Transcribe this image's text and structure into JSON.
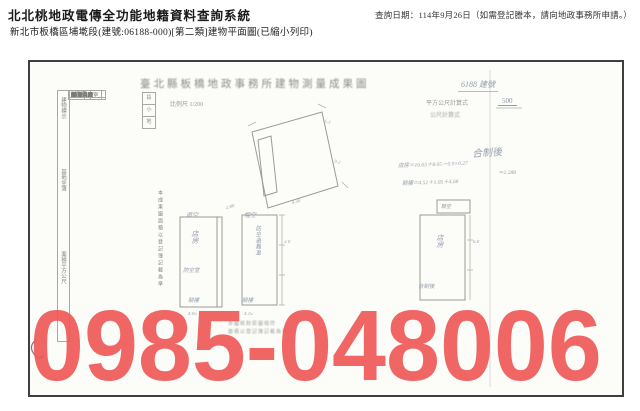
{
  "header": {
    "system_title": "北北桃地政電傳全功能地籍資料查詢系統",
    "subtitle": "新北市板橋區埔墘段(建號:06188-000)[第二類]建物平面圖(已縮小列印)",
    "query_date": "查詢日期：114年9月26日（如需登記謄本，請向地政事務所申請。）"
  },
  "document": {
    "title": "臺北縣板橋地政事務所建物測量成果圖",
    "building_no_note": "6188 建號",
    "scale": {
      "strip": [
        "段",
        "小",
        "地"
      ],
      "scale_text": "比例尺 1/200",
      "calc_label": "平方公尺計算式",
      "calc_value": "500",
      "calc_secondary": "公尺計算式"
    },
    "form": {
      "groups": [
        "建物標示",
        "基地坐落",
        "面積平方公尺"
      ],
      "side_note": "本成果圖面積以登記簿記載為準",
      "rows": [
        {
          "label": "建物門牌",
          "value": "四維路"
        },
        {
          "label": "縣市",
          "value": "臺北縣"
        },
        {
          "label": "鄉鎮市區",
          "value": "板橋市"
        },
        {
          "label": "段",
          "value": "埔墘"
        },
        {
          "label": "小段",
          "value": "─"
        },
        {
          "label": "地號",
          "value": "四〇九"
        },
        {
          "label": "主要用途",
          "value": "店房"
        },
        {
          "label": "主要構造",
          "value": "磚造"
        },
        {
          "label": "層數",
          "value": "一層"
        },
        {
          "label": "測量日期",
          "value": "─"
        },
        {
          "label": "層次",
          "value": "面積"
        },
        {
          "label": "第一層",
          "value": "29.55"
        },
        {
          "label": "騎樓",
          "value": "4.68"
        },
        {
          "label": "合計",
          "value": "34.23"
        },
        {
          "label": "附屬建物",
          "value": "防空避難室"
        },
        {
          "label": "騎樓",
          "value": "─"
        },
        {
          "label": "備考",
          "value": "─"
        },
        {
          "label": "─",
          "value": "─"
        }
      ]
    },
    "handwriting": {
      "heading": "合制後",
      "calc1": "店房＝16.63＋8.65－0.9×0.27",
      "calc2": "＝2.288",
      "calc3": "騎樓＝4.52＋1.05＋4.68"
    },
    "plan": {
      "labels": {
        "above1": "遊空",
        "above2": "埕空",
        "r1_main": "店房",
        "r1_sub": "防空室",
        "r1_below": "騎樓",
        "r2_vertical": "防空避難室",
        "r2_below": "騎樓",
        "r3_main": "店房",
        "r3_below": "合制後",
        "topbox": "騎空"
      },
      "dims": [
        "4.30",
        "2.88",
        "4.05",
        "4.15",
        "3.0",
        "6.0",
        "1.3",
        "9.2"
      ]
    },
    "stamps": [
      "本圖核對原圖相符",
      "面積以登記簿記載為準"
    ],
    "watermark": {
      "text": "0985-048006",
      "color": "#ee5a58"
    }
  }
}
